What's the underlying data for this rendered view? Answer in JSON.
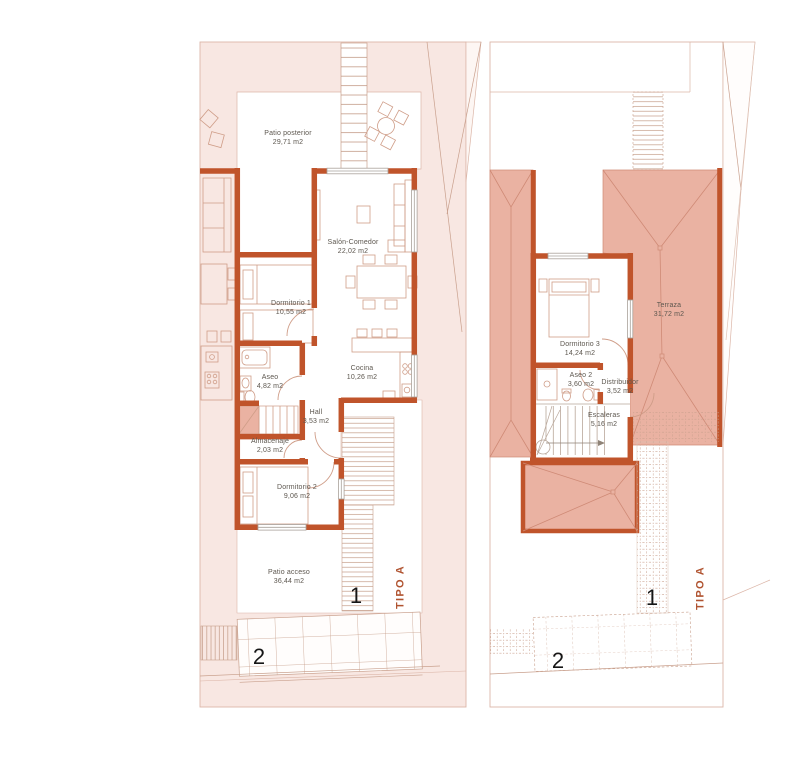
{
  "ground_floor": {
    "rooms": [
      {
        "name": "Patio posterior",
        "area": "29,71 m2"
      },
      {
        "name": "Salón-Comedor",
        "area": "22,02 m2"
      },
      {
        "name": "Dormitorio 1",
        "area": "10,55 m2"
      },
      {
        "name": "Aseo",
        "area": "4,82 m2"
      },
      {
        "name": "Cocina",
        "area": "10,26 m2"
      },
      {
        "name": "Hall",
        "area": "3,53 m2"
      },
      {
        "name": "Almacenaje",
        "area": "2,03 m2"
      },
      {
        "name": "Dormitorio 2",
        "area": "9,06 m2"
      },
      {
        "name": "Patio acceso",
        "area": "36,44 m2"
      }
    ],
    "markers": {
      "one": "1",
      "two": "2"
    },
    "type_label": "TIPO A"
  },
  "first_floor": {
    "rooms": [
      {
        "name": "Dormitorio 3",
        "area": "14,24 m2"
      },
      {
        "name": "Aseo 2",
        "area": "3,60 m2"
      },
      {
        "name": "Distribuidor",
        "area": "3,52 m2"
      },
      {
        "name": "Escaleras",
        "area": "5,16 m2"
      },
      {
        "name": "Terraza",
        "area": "31,72 m2"
      }
    ],
    "markers": {
      "one": "1",
      "two": "2"
    },
    "type_label": "TIPO A"
  },
  "colors": {
    "wall": "#c0542b",
    "roof_fill": "#eab2a2",
    "plot_fill": "#f8e7e2",
    "accent_text": "#b05330",
    "label_text": "#5d574f"
  }
}
